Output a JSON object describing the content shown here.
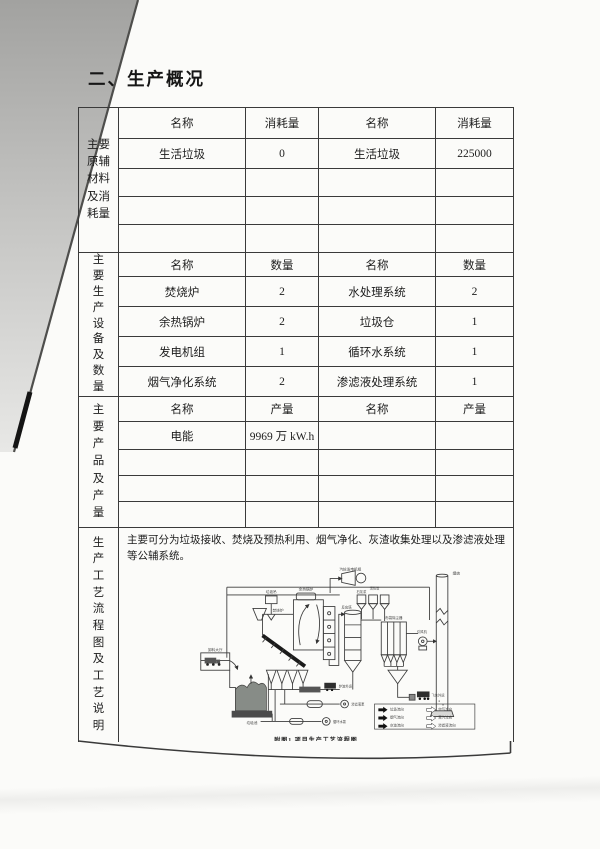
{
  "page": {
    "title": "二、生产概况"
  },
  "colors": {
    "paper": "#fbfbf9",
    "ink": "#1d1d1d",
    "table_line": "#3a3a3a",
    "scan_artifact": "#a8a8a6",
    "bunker_fill": "#878c87"
  },
  "table": {
    "sections": [
      {
        "row_label": "主要原辅材料及消耗量",
        "header": [
          "名称",
          "消耗量",
          "名称",
          "消耗量"
        ],
        "rows": [
          [
            "生活垃圾",
            "0",
            "生活垃圾",
            "225000"
          ],
          [
            "",
            "",
            "",
            ""
          ],
          [
            "",
            "",
            "",
            ""
          ],
          [
            "",
            "",
            "",
            ""
          ]
        ]
      },
      {
        "row_label": "主要生产设备及数量",
        "header": [
          "名称",
          "数量",
          "名称",
          "数量"
        ],
        "rows": [
          [
            "焚烧炉",
            "2",
            "水处理系统",
            "2"
          ],
          [
            "余热锅炉",
            "2",
            "垃圾仓",
            "1"
          ],
          [
            "发电机组",
            "1",
            "循环水系统",
            "1"
          ],
          [
            "烟气净化系统",
            "2",
            "渗滤液处理系统",
            "1"
          ]
        ]
      },
      {
        "row_label": "主要产品及产量",
        "header": [
          "名称",
          "产量",
          "名称",
          "产量"
        ],
        "rows": [
          [
            "电能",
            "9969 万 kW.h",
            "",
            ""
          ],
          [
            "",
            "",
            "",
            ""
          ],
          [
            "",
            "",
            "",
            ""
          ],
          [
            "",
            "",
            "",
            ""
          ]
        ]
      }
    ],
    "process_section": {
      "row_label": "生产工艺流程图及工艺说明",
      "description": "主要可分为垃圾接收、焚烧及预热利用、烟气净化、灰渣收集处理以及渗滤液处理等公辅系统。",
      "diagram": {
        "caption": "附图1 项目生产工艺流程图",
        "labels": {
          "turbine": "汽轮发电机组",
          "crane": "垃圾吊",
          "tipping_hall": "卸料大厅",
          "bunker": "垃圾池",
          "incinerator": "焚烧炉",
          "boiler": "余热锅炉",
          "reactor": "反应塔",
          "silo_lime": "石灰浆",
          "silo_carbon": "活性炭",
          "bag_filter": "布袋除尘器",
          "fan": "引风机",
          "chimney": "烟囱",
          "slag_truck": "炉渣外运",
          "ash_truck": "飞灰外运",
          "pump_leachate": "渗滤液泵",
          "pump_water": "循环水泵"
        },
        "legend": [
          "垃圾流向",
          "烟气流向",
          "灰渣流向",
          "空气流向",
          "蒸汽流向",
          "渗滤液流向"
        ]
      }
    }
  }
}
